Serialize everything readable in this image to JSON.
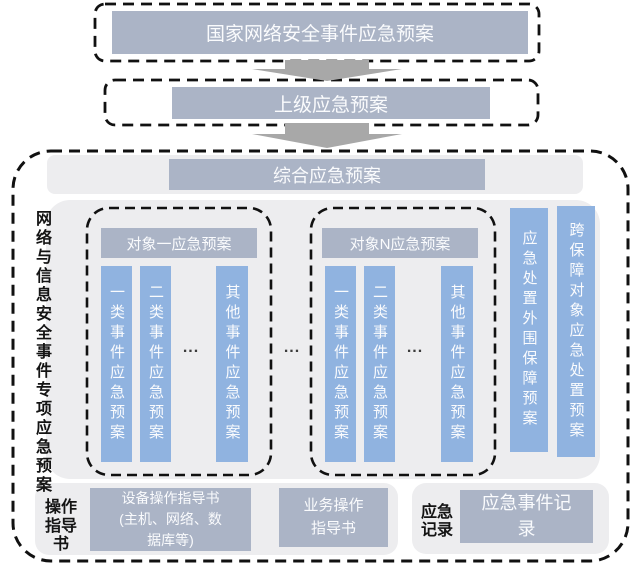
{
  "diagram": {
    "national_plan": "国家网络安全事件应急预案",
    "superior_plan": "上级应急预案",
    "special_section_label": "网络与信息安全事件专项应急预案",
    "comprehensive_plan": "综合应急预案",
    "object_groups": [
      {
        "header": "对象一应急预案",
        "columns": [
          "一类事件应急预案",
          "二类事件应急预案",
          "其他事件应急预案"
        ],
        "ellipsis": "..."
      },
      {
        "header": "对象N应急预案",
        "columns": [
          "一类事件应急预案",
          "二类事件应急预案",
          "其他事件应急预案"
        ],
        "ellipsis": "..."
      }
    ],
    "groups_ellipsis": "...",
    "side_plans": [
      "应急处置外围保障预案",
      "跨保障对象应急处置预案"
    ],
    "operation_guide": {
      "label": "操作指导书",
      "device_guide": "设备操作指导书\n(主机、网络、数\n据库等)",
      "business_guide": "业务操作\n指导书"
    },
    "emergency_record": {
      "label": "应急记录",
      "record": "应急事件记\n录"
    }
  },
  "colors": {
    "box_bluegray": "#abb4c6",
    "bar_blue": "#90b3e0",
    "panel_gray": "#ededef",
    "arrow_gray": "#a8a8a8",
    "dash_black": "#111111"
  }
}
